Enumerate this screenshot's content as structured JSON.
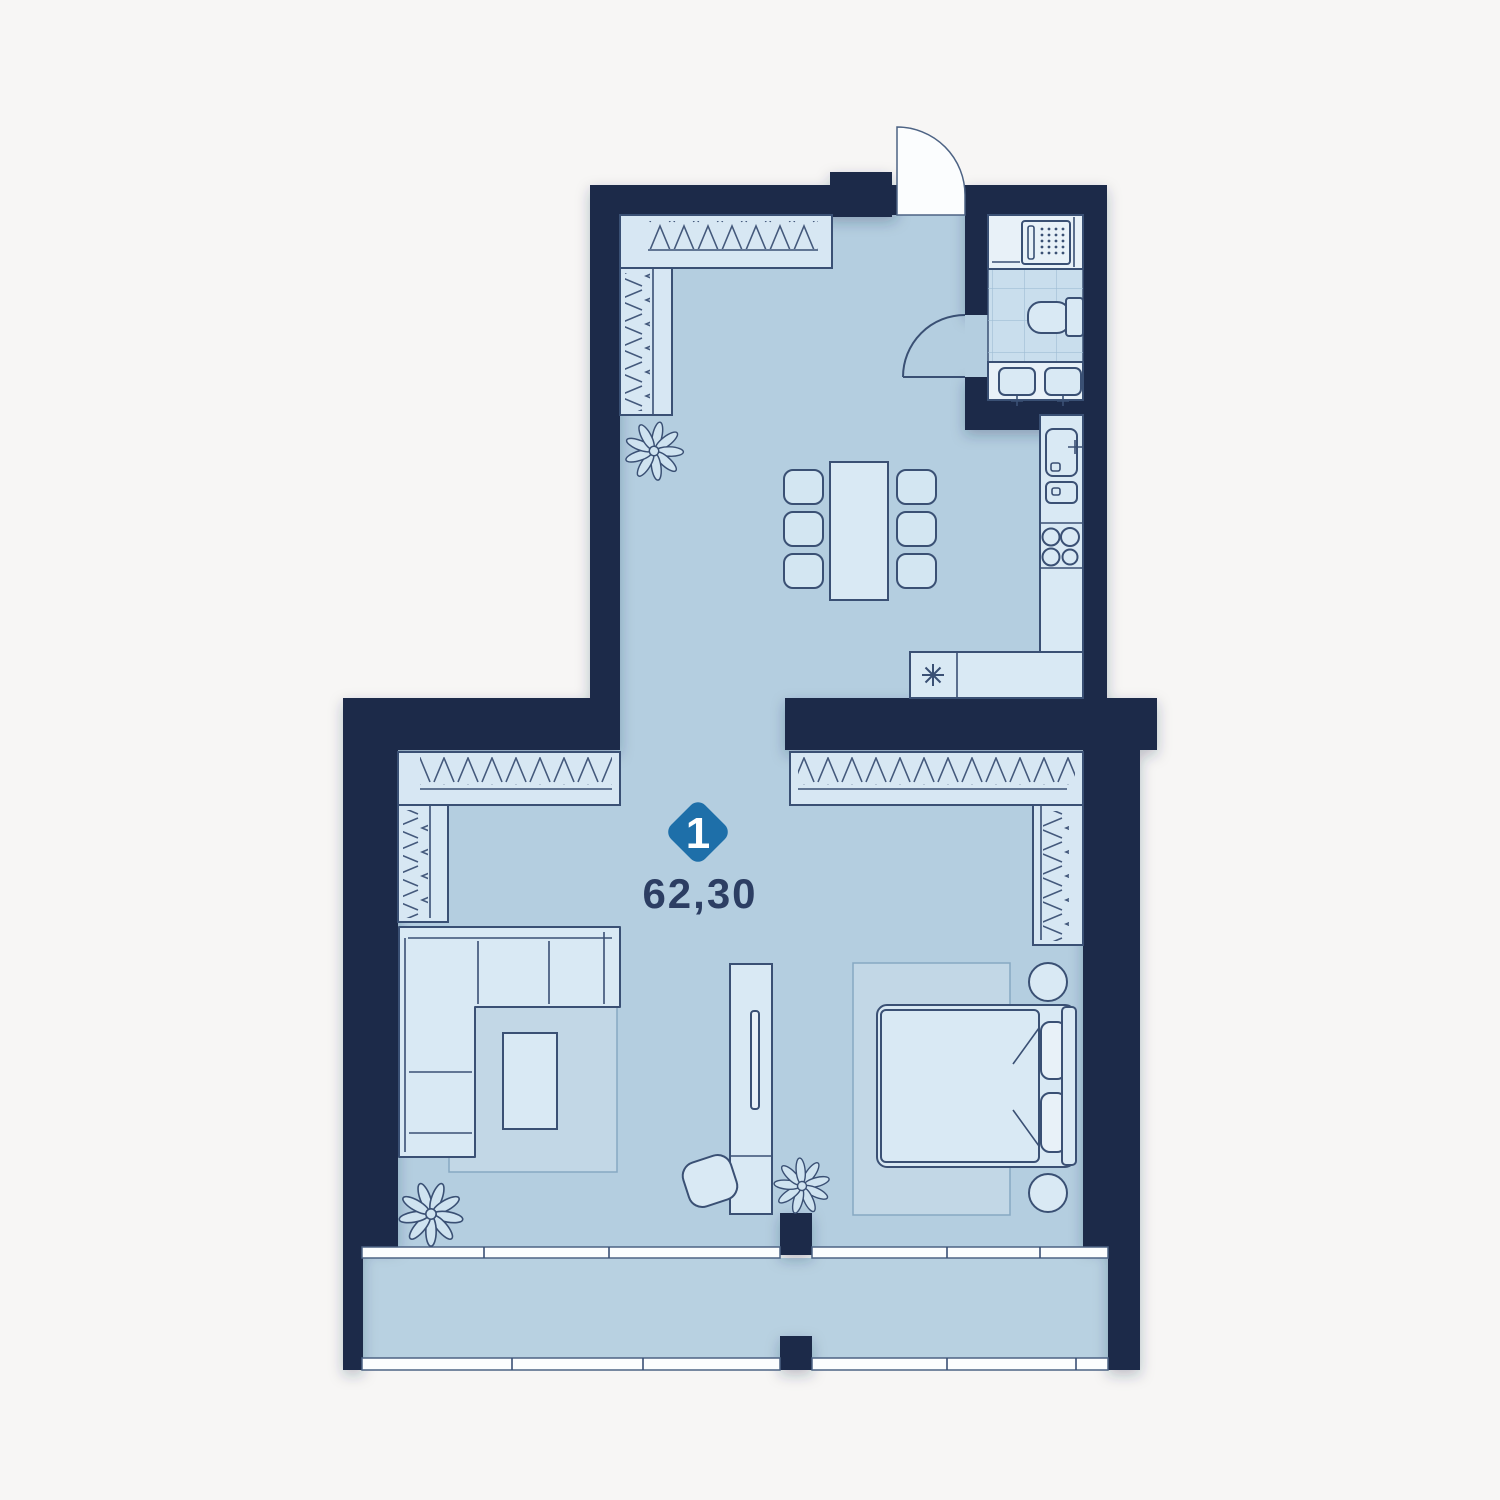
{
  "page": {
    "background_color": "#f7f6f5"
  },
  "plan": {
    "type": "apartment-floor-plan",
    "badge": {
      "number": "1",
      "shape": "diamond",
      "color": "#1e6fa9",
      "text_color": "#ffffff"
    },
    "area_label": "62,30",
    "area_label_color": "#2c3e63",
    "colors": {
      "wall": "#1c2a4a",
      "floor": "#b4cee0",
      "balcony_floor": "#b8d1e1",
      "furniture_fill": "#d9e9f4",
      "furniture_outline": "#3a5074",
      "window": "#fbfdfe",
      "bathroom_tile": "#c9deed"
    },
    "icons": [
      "entry-door-icon",
      "bathroom-door-icon",
      "washing-machine-icon",
      "toilet-icon",
      "double-sink-icon",
      "kitchen-sink-icon",
      "cooktop-icon",
      "hob-star-icon",
      "dining-table-icon",
      "chair-icon",
      "wardrobe-hatch-icon",
      "sofa-icon",
      "coffee-table-icon",
      "rug-icon",
      "tv-unit-icon",
      "pouf-icon",
      "bed-icon",
      "pillow-icon",
      "nightstand-icon",
      "plant-icon",
      "window-icon",
      "balcony-icon"
    ]
  }
}
